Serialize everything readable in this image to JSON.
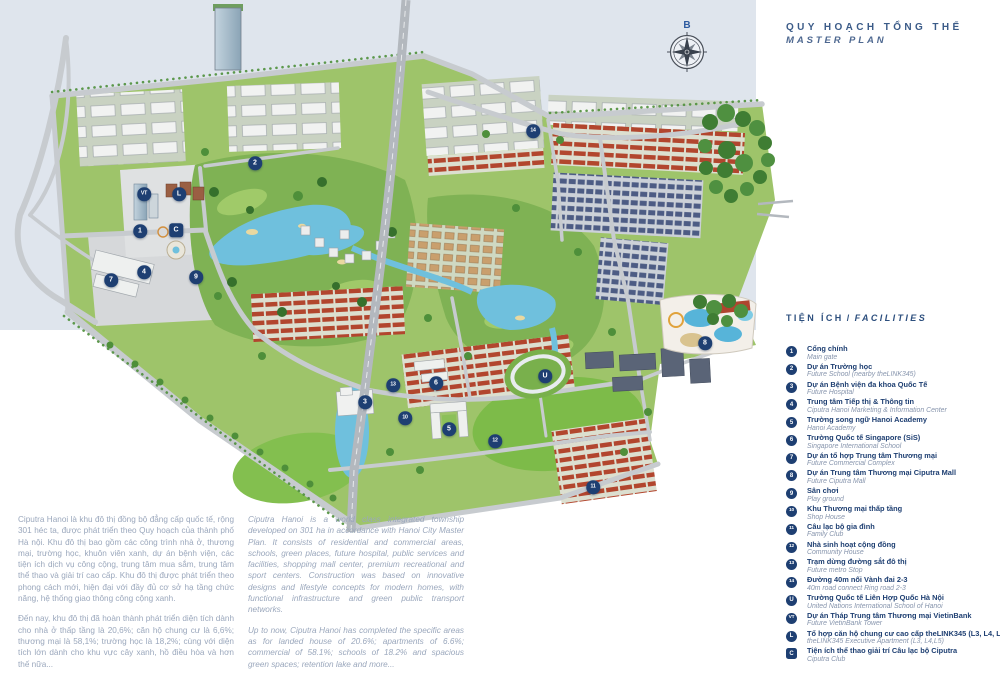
{
  "title": {
    "vi": "QUY HOẠCH TỔNG THỂ",
    "en": "MASTER PLAN"
  },
  "compass": {
    "north_label": "B"
  },
  "colors": {
    "accent_navy": "#1e3f72",
    "legend_secondary": "#8795ad",
    "paragraph_text": "#9aa7bc",
    "title_text": "#3b5b88",
    "river": "#dfe5ed"
  },
  "legend": {
    "header_vi": "TIỆN ÍCH",
    "header_sep": "/",
    "header_en": "FACILITIES",
    "items": [
      {
        "id": "1",
        "vi": "Cổng chính",
        "en": "Main gate"
      },
      {
        "id": "2",
        "vi": "Dự án Trường học",
        "en": "Future School (nearby theLINK345)"
      },
      {
        "id": "3",
        "vi": "Dự án Bệnh viện đa khoa Quốc Tế",
        "en": "Future Hospital"
      },
      {
        "id": "4",
        "vi": "Trung tâm Tiếp thị & Thông tin",
        "en": "Ciputra Hanoi Marketing & Information Center"
      },
      {
        "id": "5",
        "vi": "Trường song ngữ Hanoi Academy",
        "en": "Hanoi Academy"
      },
      {
        "id": "6",
        "vi": "Trường Quốc tế Singapore (SiS)",
        "en": "Singapore International School"
      },
      {
        "id": "7",
        "vi": "Dự án tổ hợp Trung tâm Thương mại",
        "en": "Future Commercial Complex"
      },
      {
        "id": "8",
        "vi": "Dự án Trung tâm Thương mại Ciputra Mall",
        "en": "Future Ciputra Mall"
      },
      {
        "id": "9",
        "vi": "Sân chơi",
        "en": "Play ground"
      },
      {
        "id": "10",
        "vi": "Khu Thương mại thấp tầng",
        "en": "Shop House"
      },
      {
        "id": "11",
        "vi": "Câu lạc bộ gia đình",
        "en": "Family Club"
      },
      {
        "id": "12",
        "vi": "Nhà sinh hoạt cộng đồng",
        "en": "Community House"
      },
      {
        "id": "13",
        "vi": "Trạm dừng đường sắt đô thị",
        "en": "Future metro Stop"
      },
      {
        "id": "14",
        "vi": "Đường 40m nối Vành đai 2-3",
        "en": "40m road connect Ring road 2-3"
      },
      {
        "id": "U",
        "vi": "Trường Quốc tế Liên Hợp Quốc Hà Nội",
        "en": "United Nations International School of Hanoi"
      },
      {
        "id": "VT",
        "vi": "Dự án Tháp Trung tâm Thương mại VietinBank",
        "en": "Future VietinBank Tower"
      },
      {
        "id": "L",
        "vi": "Tổ hợp căn hộ chung cư cao cấp theLINK345 (L3, L4, L5)",
        "en": "theLINK345 Executive Apartment (L3, L4,L5)"
      },
      {
        "id": "C",
        "vi": "Tiện ích thể thao giải trí Câu lạc bộ Ciputra",
        "en": "Ciputra Club",
        "shape": "square"
      }
    ]
  },
  "map_markers": [
    {
      "id": "1",
      "x": 140,
      "y": 231
    },
    {
      "id": "2",
      "x": 255,
      "y": 163
    },
    {
      "id": "3",
      "x": 365,
      "y": 402
    },
    {
      "id": "4",
      "x": 144,
      "y": 272
    },
    {
      "id": "5",
      "x": 449,
      "y": 429
    },
    {
      "id": "6",
      "x": 436,
      "y": 383
    },
    {
      "id": "7",
      "x": 111,
      "y": 280
    },
    {
      "id": "8",
      "x": 705,
      "y": 343
    },
    {
      "id": "9",
      "x": 196,
      "y": 277
    },
    {
      "id": "10",
      "x": 405,
      "y": 418
    },
    {
      "id": "11",
      "x": 593,
      "y": 487
    },
    {
      "id": "12",
      "x": 495,
      "y": 441
    },
    {
      "id": "13",
      "x": 393,
      "y": 385
    },
    {
      "id": "14",
      "x": 533,
      "y": 131
    },
    {
      "id": "U",
      "x": 545,
      "y": 376
    },
    {
      "id": "VT",
      "x": 144,
      "y": 194
    },
    {
      "id": "L",
      "x": 179,
      "y": 194
    },
    {
      "id": "C",
      "x": 176,
      "y": 230,
      "shape": "square"
    }
  ],
  "about": {
    "vi": [
      "Ciputra Hanoi là khu đô thị đồng bộ đẳng cấp quốc tế, rộng 301 héc ta, được phát triển theo Quy hoạch của thành phố Hà nội. Khu đô thị bao gồm các công trình nhà ở, thương mại, trường học, khuôn viên xanh, dự án bệnh viện, các tiện ích dịch vụ công cộng, trung tâm mua sắm, trung tâm thể thao và giải trí cao cấp. Khu đô thị được phát triển theo phong cách mới, hiện đại với đầy đủ cơ sở hạ tầng chức năng, hệ thống giao thông công cộng xanh.",
      "Đến nay, khu đô thị đã hoàn thành phát triển diện tích dành cho nhà ở thấp tầng là 20,6%; căn hộ chung cư là 6,6%; thương mại là 58,1%; trường học là 18,2%; cùng với diện tích lớn dành cho khu vực cây xanh, hồ điều hòa và hơn thế nữa..."
    ],
    "en": [
      "Ciputra Hanoi is a world class integrated township developed on 301 ha in accordance with Hanoi City Master Plan. It consists of residential and commercial areas, schools, green places, future hospital, public services and facilities, shopping mall center, premium recreational and sport centers. Construction was based on innovative designs and lifestyle concepts for modern homes, with functional infrastructure and green public transport networks.",
      "Up to now, Ciputra Hanoi has completed the specific areas as for landed house of 20.6%; apartments of 6.6%; commercial of 58.1%; schools of 18.2% and spacious green spaces; retention lake and more..."
    ]
  }
}
